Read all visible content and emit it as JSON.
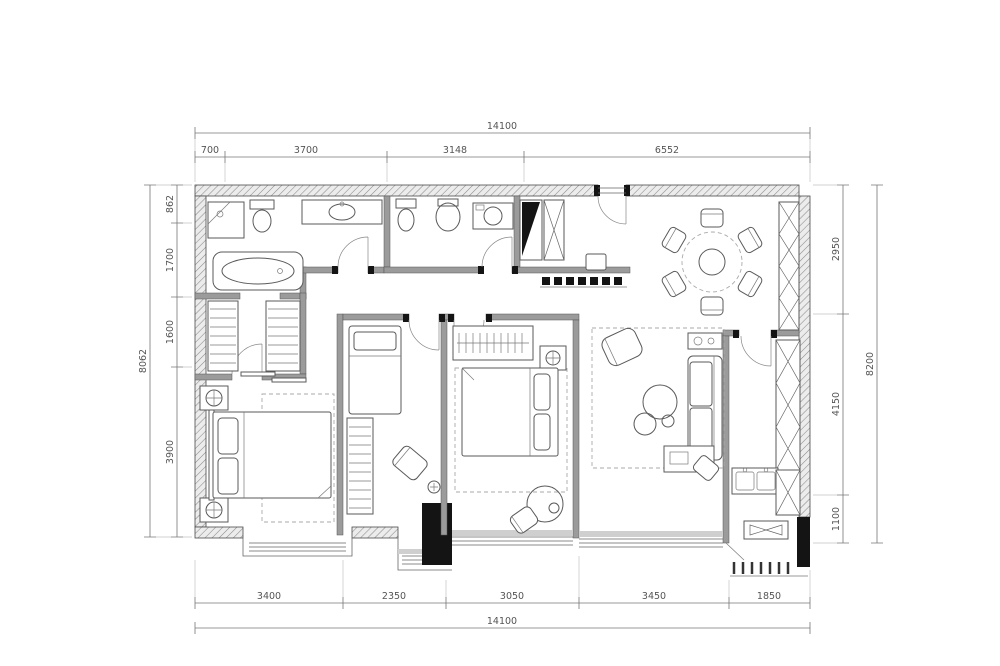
{
  "drawing": {
    "type": "apartment-floor-plan",
    "dimensions": {
      "top": {
        "overall": "14100",
        "segments": [
          "700",
          "3700",
          "3148",
          "6552"
        ]
      },
      "bottom": {
        "overall": "14100",
        "segments": [
          "3400",
          "2350",
          "3050",
          "3450",
          "1850"
        ]
      },
      "left": {
        "overall": "8062",
        "segments": [
          "862",
          "1700",
          "1600",
          "3900"
        ]
      },
      "right": {
        "overall": "8200",
        "segments": [
          "2950",
          "4150",
          "1100"
        ]
      }
    },
    "palette": {
      "background": "#ffffff",
      "wall_hatch": "#8a8a8a",
      "partition_gray": "#9b9b9b",
      "line": "#555555",
      "structure_black": "#141414",
      "dimension_text": "#555555"
    }
  }
}
